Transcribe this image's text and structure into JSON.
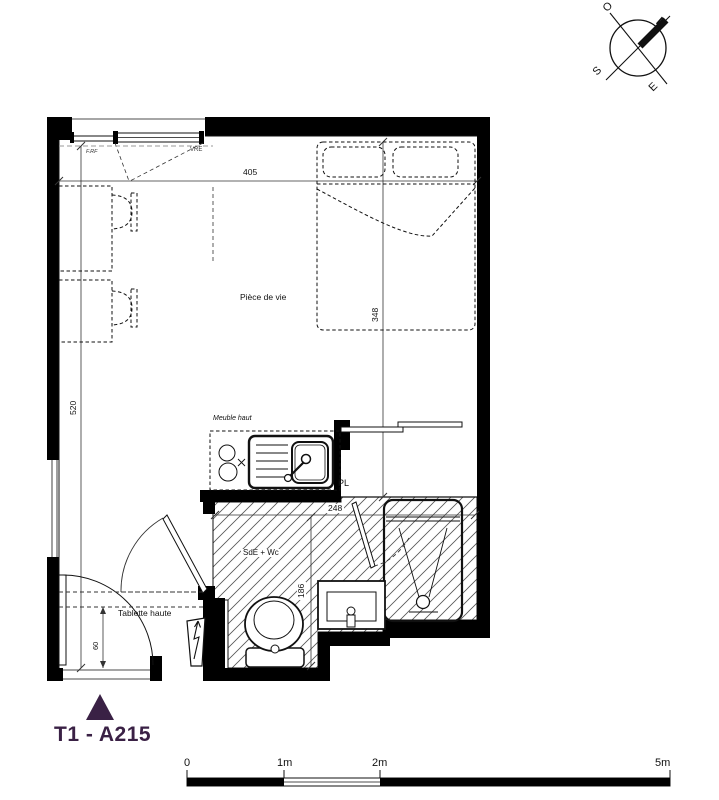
{
  "plan_title": {
    "unit_code": "T1 - A215"
  },
  "compass": {
    "north": "N",
    "south": "S",
    "east": "E",
    "west": "O"
  },
  "room_labels": {
    "living_room": "Pièce de vie",
    "bathroom": "SdE + Wc",
    "closet": "PL"
  },
  "annotations": {
    "upper_cabinet": "Meuble haut",
    "high_shelf": "Tablette haute",
    "window_tag": "F.RF",
    "shutter_tag": "VRE"
  },
  "dimensions_cm": {
    "living_width": "405",
    "living_depth": "520",
    "bed_zone_depth": "348",
    "bathroom_width": "248",
    "bathroom_depth": "186",
    "shelf_depth": "60"
  },
  "scale_bar": {
    "tick_0": "0",
    "tick_1": "1m",
    "tick_2": "2m",
    "tick_5": "5m"
  },
  "colors": {
    "accent": "#3a2145",
    "walls": "#000000",
    "hatch": "#555555"
  }
}
